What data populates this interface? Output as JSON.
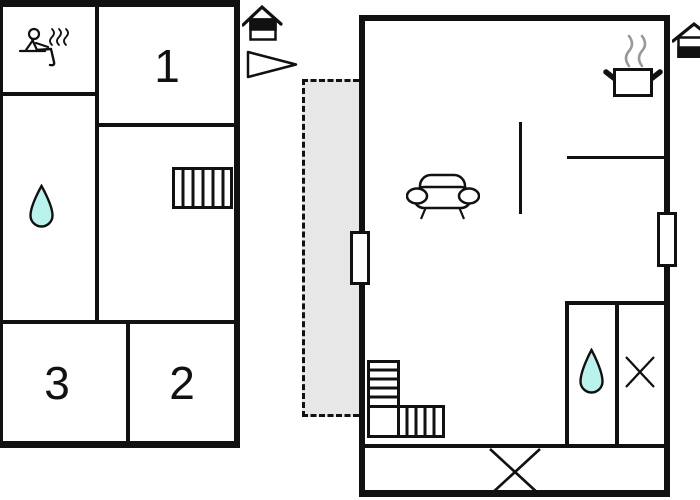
{
  "plan_title": "holiday-home-floor-plan",
  "colors": {
    "wall": "#111111",
    "terrace_fill": "#e7e7e7",
    "water_drop_fill": "#baf2ee",
    "pot_steam_gray": "#999999",
    "background": "#ffffff"
  },
  "left_building": {
    "rooms": [
      {
        "label": "1"
      },
      {
        "label": "2"
      },
      {
        "label": "3"
      }
    ],
    "features": [
      "sauna-icon",
      "water-drop-icon",
      "staircase-straight"
    ]
  },
  "right_building": {
    "features": [
      "cooking-pot-icon",
      "sofa-icon",
      "water-drop-icon",
      "staircase-l-shaped",
      "window-cross-small",
      "window-cross-large",
      "window-left",
      "window-right"
    ]
  },
  "site": {
    "features": [
      "entrance-house-icon-left",
      "entrance-house-icon-right",
      "direction-arrow-icon",
      "terrace-dashed"
    ]
  }
}
